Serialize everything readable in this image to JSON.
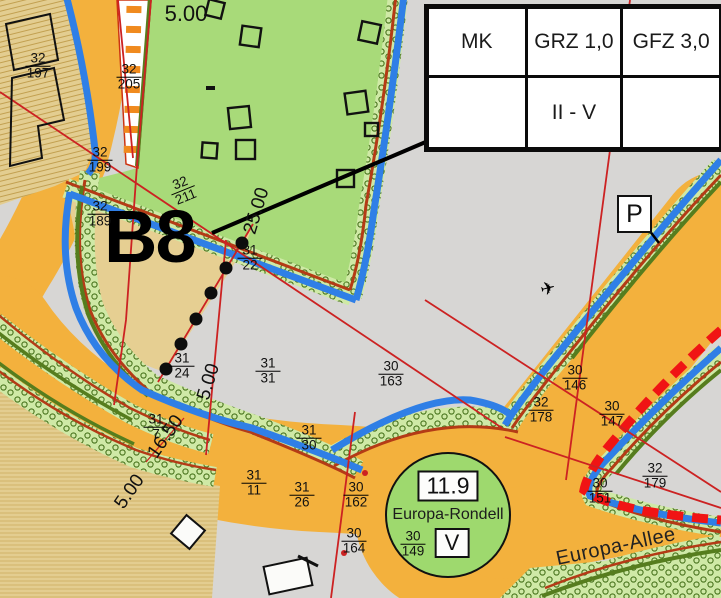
{
  "legend_table": {
    "rows": [
      [
        "MK",
        "GRZ 1,0",
        "GFZ 3,0"
      ],
      [
        "",
        "II - V",
        ""
      ]
    ]
  },
  "plan_area_label": "B8",
  "parking_label": "P",
  "aircraft_symbol": "✈",
  "rondell": {
    "height_value": "11.9",
    "name": "Europa-Rondell",
    "parcel_num": "30",
    "parcel_den": "149",
    "storeys": "V"
  },
  "street": {
    "name": "Europa-Allee"
  },
  "parcel_labels": [
    {
      "num": "32",
      "den": "197",
      "x": 38,
      "y": 66,
      "rot": 0
    },
    {
      "num": "32",
      "den": "199",
      "x": 100,
      "y": 160,
      "rot": 0
    },
    {
      "num": "32",
      "den": "205",
      "x": 129,
      "y": 77,
      "rot": 0
    },
    {
      "num": "32",
      "den": "189",
      "x": 100,
      "y": 214,
      "rot": 0
    },
    {
      "num": "32",
      "den": "211",
      "x": 183,
      "y": 190,
      "rot": -22
    },
    {
      "num": "31",
      "den": "22",
      "x": 250,
      "y": 258,
      "rot": 0
    },
    {
      "num": "31",
      "den": "24",
      "x": 182,
      "y": 366,
      "rot": 0
    },
    {
      "num": "31",
      "den": "31",
      "x": 268,
      "y": 371,
      "rot": 0
    },
    {
      "num": "30",
      "den": "163",
      "x": 391,
      "y": 374,
      "rot": 0
    },
    {
      "num": "31",
      "den": "30",
      "x": 309,
      "y": 438,
      "rot": 0
    },
    {
      "num": "31",
      "den": "11",
      "x": 254,
      "y": 483,
      "rot": 0
    },
    {
      "num": "31",
      "den": "26",
      "x": 302,
      "y": 495,
      "rot": 0
    },
    {
      "num": "30",
      "den": "162",
      "x": 356,
      "y": 495,
      "rot": 0
    },
    {
      "num": "30",
      "den": "164",
      "x": 354,
      "y": 541,
      "rot": 0
    },
    {
      "num": "31",
      "den": "7",
      "x": 156,
      "y": 427,
      "rot": 0
    },
    {
      "num": "30",
      "den": "146",
      "x": 575,
      "y": 378,
      "rot": 0
    },
    {
      "num": "32",
      "den": "178",
      "x": 541,
      "y": 410,
      "rot": 0
    },
    {
      "num": "30",
      "den": "147",
      "x": 612,
      "y": 414,
      "rot": 0
    },
    {
      "num": "32",
      "den": "179",
      "x": 655,
      "y": 476,
      "rot": 0
    },
    {
      "num": "30",
      "den": "151",
      "x": 600,
      "y": 491,
      "rot": 0
    }
  ],
  "dimension_labels": [
    {
      "text": "5.00",
      "x": 186,
      "y": 14,
      "rot": 0,
      "size": 22
    },
    {
      "text": "25.00",
      "x": 257,
      "y": 211,
      "rot": -73,
      "size": 19
    },
    {
      "text": "5.00",
      "x": 209,
      "y": 382,
      "rot": -73,
      "size": 19
    },
    {
      "text": "16.50",
      "x": 166,
      "y": 437,
      "rot": -55,
      "size": 19
    },
    {
      "text": "5.00",
      "x": 130,
      "y": 492,
      "rot": -55,
      "size": 19
    }
  ],
  "colors": {
    "road_orange": "#f3b13d",
    "parcel_green": "#a8da79",
    "band_green": "#cfe9a6",
    "tan": "#e3cd90",
    "gray": "#d7d6d4",
    "blue_line": "#2f7fe6",
    "red_line": "#cc2222",
    "dark_red": "#b43b16",
    "dark_green": "#567d1e",
    "boundary_red": "#f01414"
  }
}
